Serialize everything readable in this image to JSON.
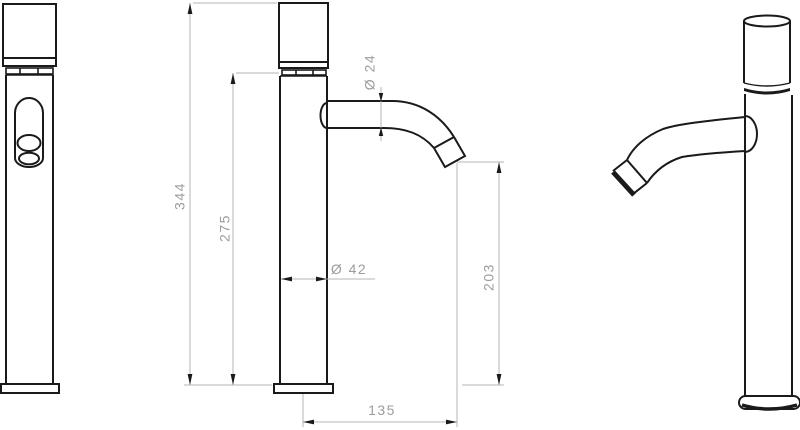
{
  "drawing": {
    "dimensions": {
      "total_height": "344",
      "body_height": "275",
      "spout_diameter": "Ø 24",
      "body_diameter": "Ø 42",
      "spout_outlet_height": "203",
      "spout_reach": "135"
    },
    "colors": {
      "outline": "#1a1a1a",
      "dimension_line": "#b5b5b5",
      "arrowhead": "#1a1a1a",
      "label_text": "#9c9c9c",
      "background": "#ffffff"
    }
  }
}
